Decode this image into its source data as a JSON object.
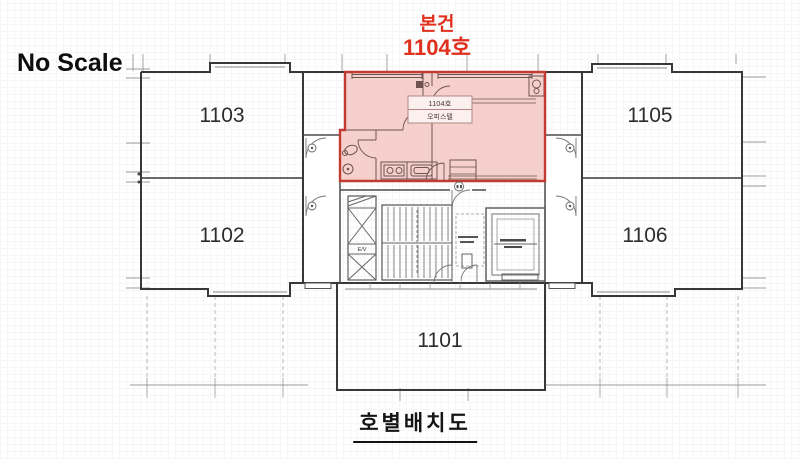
{
  "scale_note": "No Scale",
  "drawing_title": "호별배치도",
  "callout": {
    "line1": "본건",
    "line2": "1104호",
    "color": "#e0301e"
  },
  "subject_unit": {
    "number": "1104호",
    "type": "오피스텔",
    "fill": "#f5c8c4",
    "border": "#c23b33"
  },
  "units": {
    "u1101": {
      "label": "1101"
    },
    "u1102": {
      "label": "1102"
    },
    "u1103": {
      "label": "1103"
    },
    "u1105": {
      "label": "1105"
    },
    "u1106": {
      "label": "1106"
    }
  },
  "core": {
    "elevator": "E/V"
  },
  "colors": {
    "walls": "#383838",
    "ticks": "#9b9b9b"
  }
}
